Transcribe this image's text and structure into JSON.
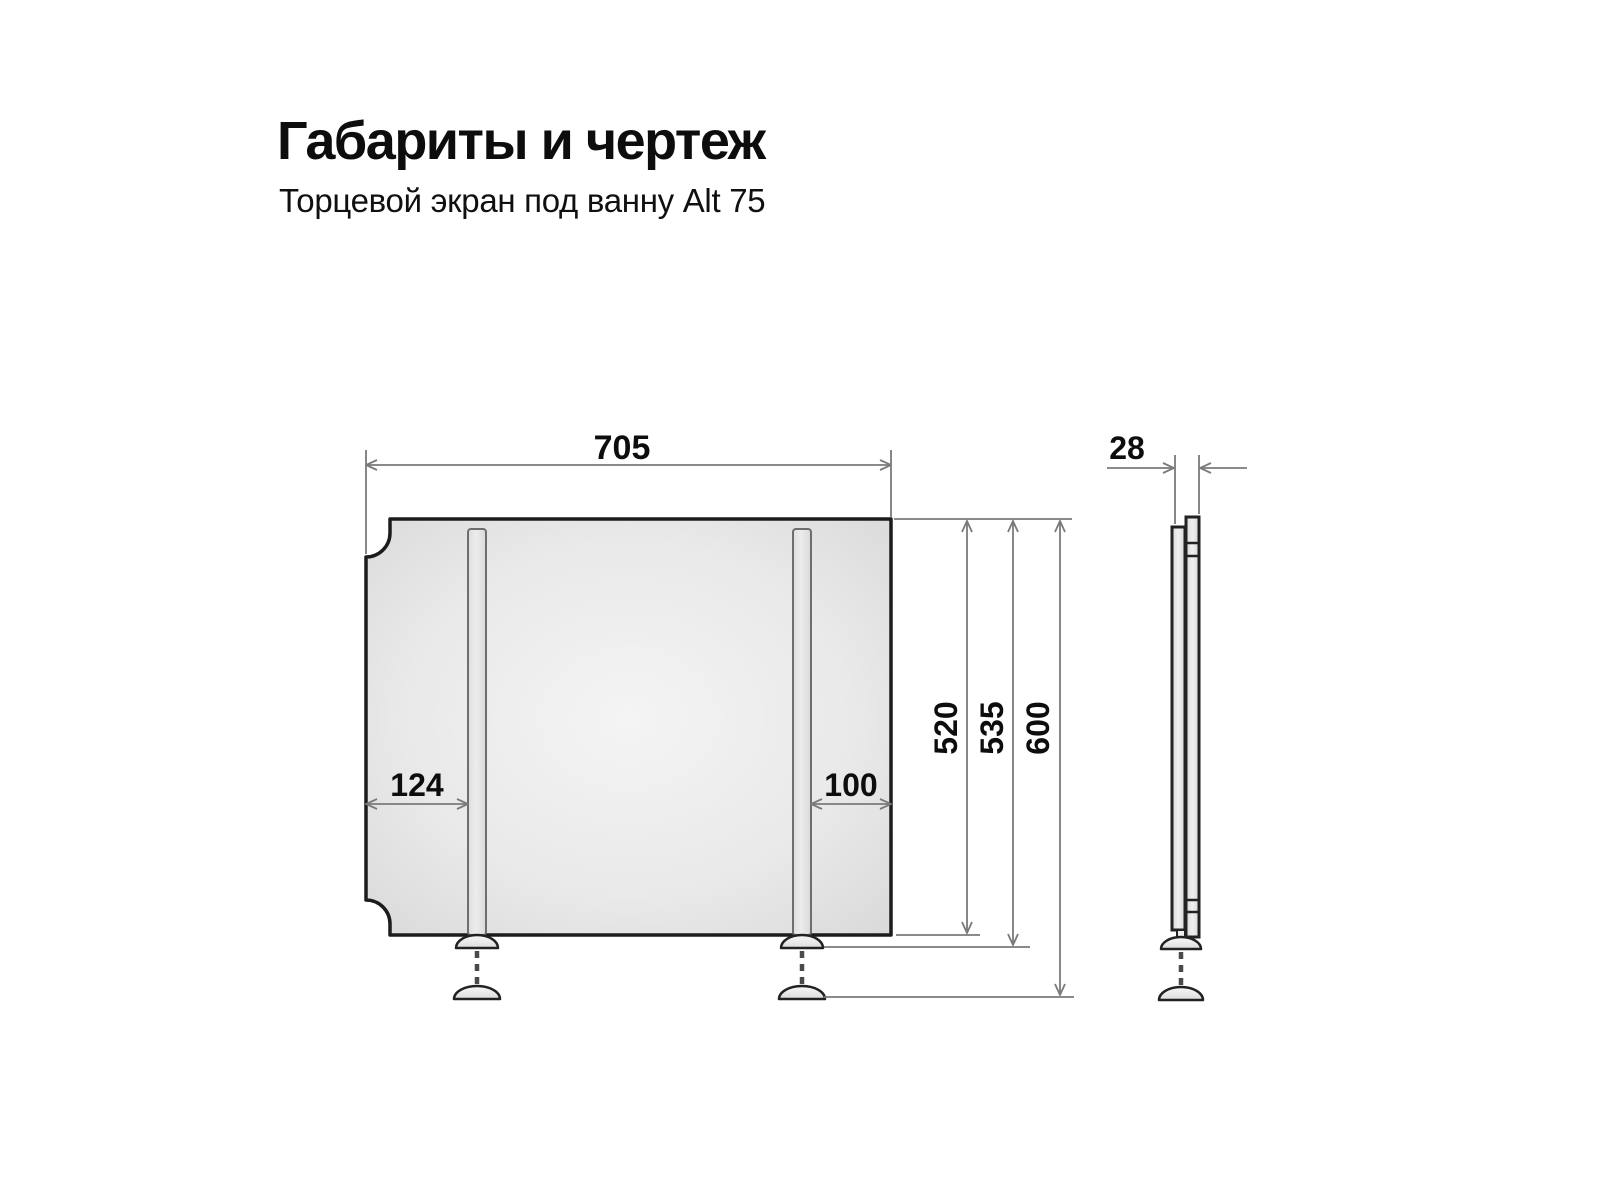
{
  "header": {
    "title": "Габариты и чертеж",
    "subtitle": "Торцевой экран под ванну Alt 75"
  },
  "drawing": {
    "front_view": {
      "width_label": "705",
      "left_rail_offset_label": "124",
      "right_rail_offset_label": "100",
      "panel_height_label": "520",
      "height_to_foot_label": "535",
      "max_height_label": "600"
    },
    "side_view": {
      "thickness_label": "28"
    },
    "colors": {
      "outline": "#1c1c1c",
      "dimension_lines": "#7a7a7a",
      "panel_fill_center": "#f3f3f3",
      "panel_fill_edge": "#d6d6d6",
      "background": "#ffffff"
    }
  }
}
